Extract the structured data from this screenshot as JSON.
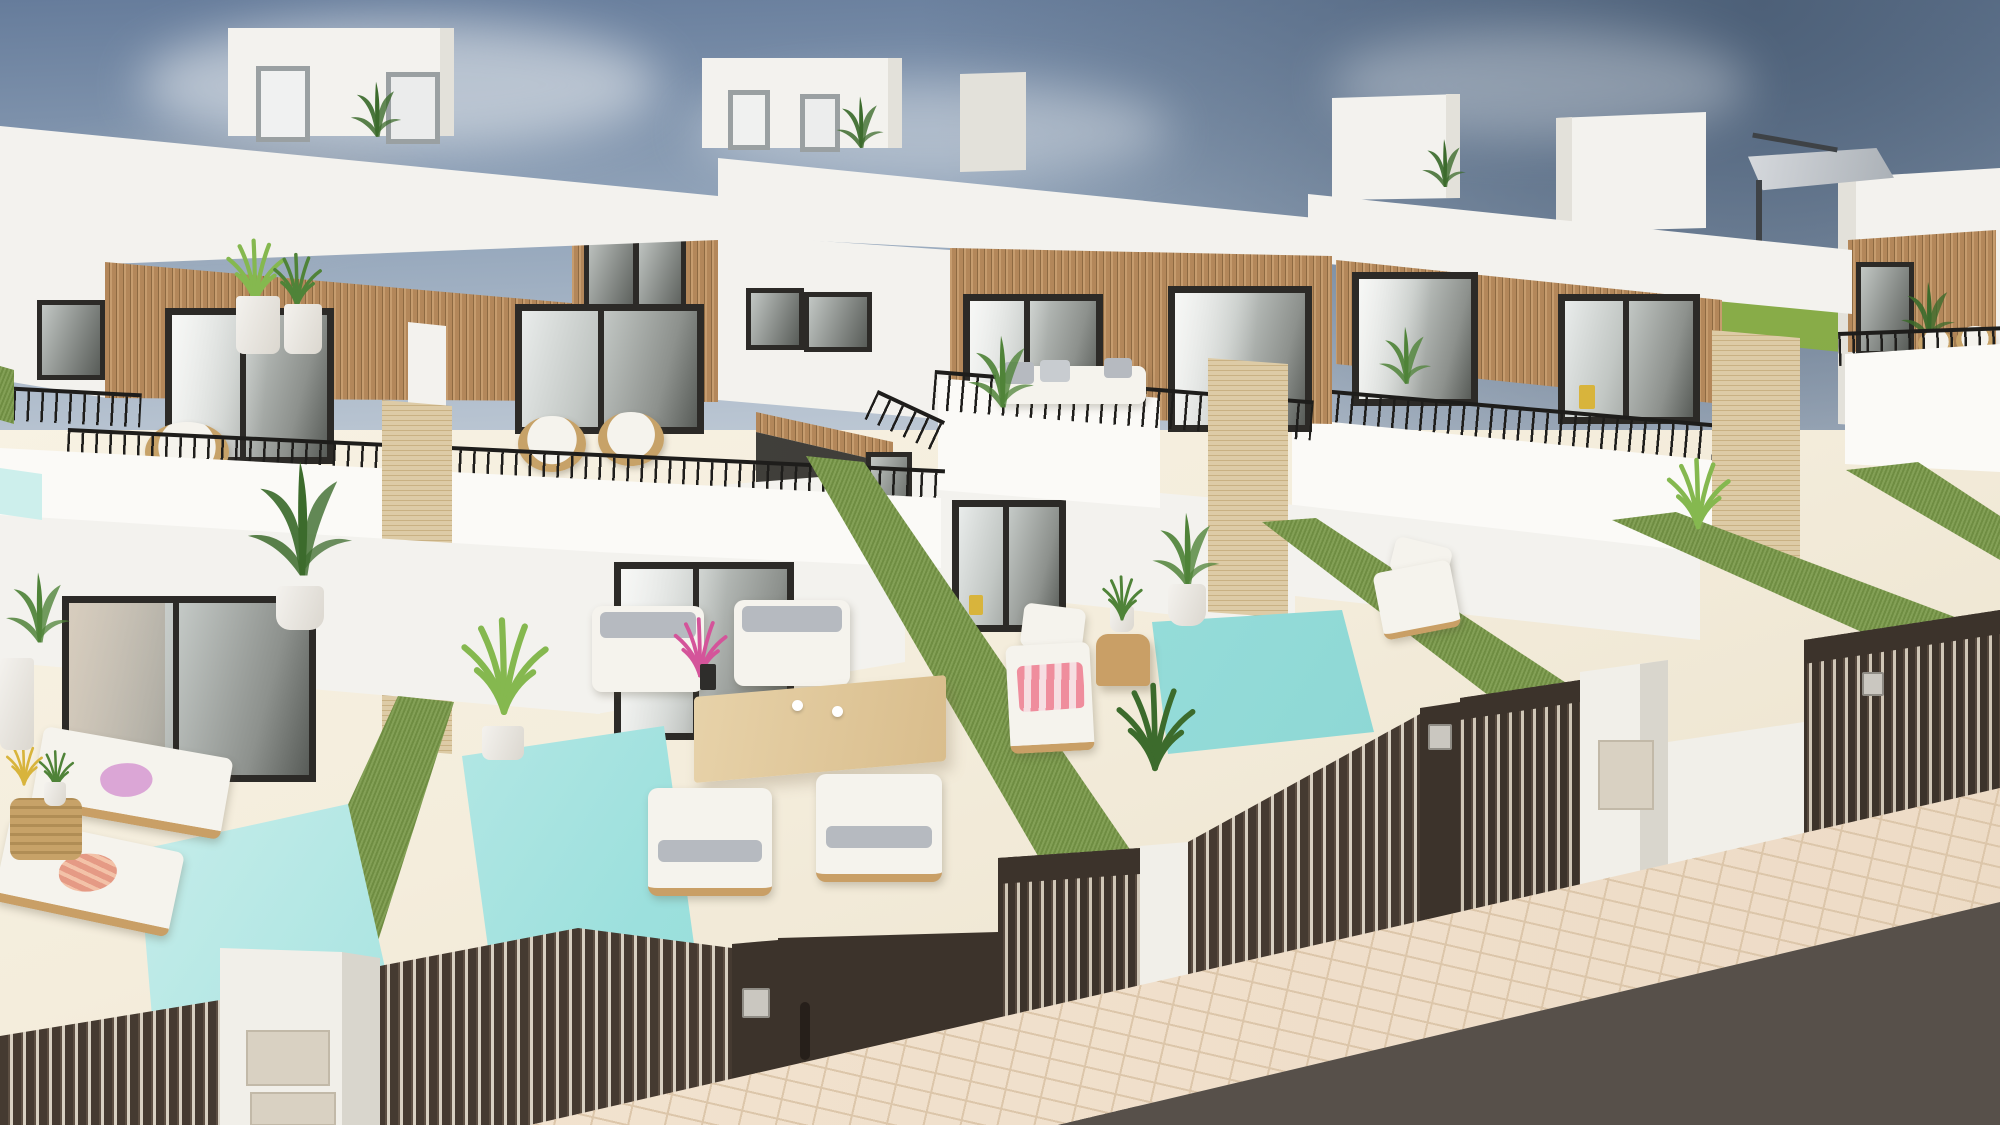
{
  "meta": {
    "type": "architectural-3d-exterior-render",
    "subject": "row of modern white two-storey villas with private plunge pools, artificial-grass hedge walls, dark slatted street gates and rooftop terraces, aerial three-quarter view",
    "visible_text": "none"
  },
  "scene": {
    "houses": 4,
    "pools": 3,
    "sun_loungers": 4,
    "dining_chairs": 4,
    "balcony_wicker_chairs": 5,
    "street_gates": 4,
    "entrance_pillars_with_letterbox": 2,
    "rooftop_parasol": 1,
    "towel_colors": [
      "pink",
      "coral-stripe",
      "pink-stripe"
    ],
    "plants": "banana plants, palms, grasses in white pots"
  },
  "palette": {
    "sky-top": "#667c9b",
    "sky-mid": "#93a5ba",
    "sky-low": "#c3cdd8",
    "sky-hor": "#dde2e8",
    "sky-deep": "#4d6078",
    "cloud": "#eef1f3",
    "field": "#7da23f",
    "field-lt": "#8cb04c",
    "wall": "#f3f2ee",
    "wall-br": "#fbfaf7",
    "wall-sh": "#e3e1da",
    "wall-dk": "#d3d1c9",
    "wood": "#b3875a",
    "wood-dk": "#8e6a42",
    "wood-lt": "#c69c6e",
    "frame": "#2c2a27",
    "glass-a": "#e9eceb",
    "glass-b": "#c2c7c4",
    "glass-c": "#8d918d",
    "glass-d": "#585c58",
    "railing": "#1e1d1b",
    "stone": "#ddcba6",
    "stone-ln": "#c9b183",
    "hedge": "#7b9a4b",
    "patio": "#f4eddc",
    "patio-br": "#faf5e8",
    "patio-sh": "#e9dfc9",
    "pool-lt": "#cdefec",
    "pool-md": "#9ce0dd",
    "pool-dp": "#7bcdca",
    "fence": "#453a31",
    "fence-hi": "#5c4e42",
    "fence-gap": "#d8d0c2",
    "gate": "#3c332b",
    "gate-hi": "#55483d",
    "gate-gap": "#cfc6b6",
    "pillar": "#f1efe9",
    "pillar-sh": "#d9d6cd",
    "letterbox": "#d9d1c2",
    "walk": "#eddbc6",
    "walk-lt": "#f4e6d3",
    "walk-ln": "#dcc6aa",
    "road": "#57504a",
    "road-lt": "#6b635c",
    "wood-furn": "#c99f66",
    "wood-furn-lt": "#e7d2a9",
    "cushion": "#f5f3ed",
    "pillow": "#b6bac0",
    "towel-pink": "#dba6d6",
    "towel-coral": "#e59a85",
    "towel-stripe": "#ef8d9d",
    "plant": "#4f8338",
    "plant-dk": "#3c6b2c",
    "plant-lt": "#85b84f",
    "pot": "#f4f2ee",
    "wick": "#c7a268",
    "parasol": "#d6d9dd",
    "parasol-dk": "#3e4246",
    "keypad": "#cac7c0"
  }
}
